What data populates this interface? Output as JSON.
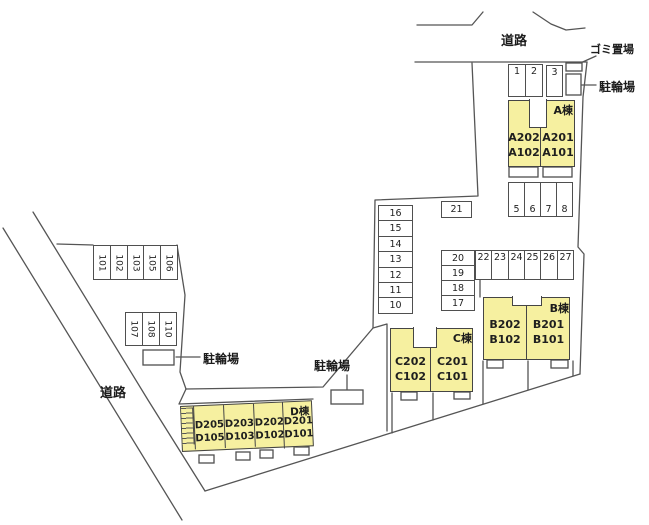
{
  "plan": {
    "roads": {
      "top": "道路",
      "left": "道路"
    },
    "facilities": {
      "garbage": "ゴミ置場",
      "bike_top": "駐輪場",
      "bike_left": "駐輪場",
      "bike_mid": "駐輪場"
    },
    "buildings": {
      "a": {
        "name": "A棟",
        "units": [
          {
            "top": "A202",
            "bottom": "A102"
          },
          {
            "top": "A201",
            "bottom": "A101"
          }
        ]
      },
      "b": {
        "name": "B棟",
        "units": [
          {
            "top": "B202",
            "bottom": "B102"
          },
          {
            "top": "B201",
            "bottom": "B101"
          }
        ]
      },
      "c": {
        "name": "C棟",
        "units": [
          {
            "top": "C202",
            "bottom": "C102"
          },
          {
            "top": "C201",
            "bottom": "C101"
          }
        ]
      },
      "d": {
        "name": "D棟",
        "units": [
          {
            "top": "D205",
            "bottom": "D105"
          },
          {
            "top": "D203",
            "bottom": "D103"
          },
          {
            "top": "D202",
            "bottom": "D102"
          },
          {
            "top": "D201",
            "bottom": "D101"
          }
        ]
      }
    },
    "parking": {
      "row_1_2": [
        "1",
        "2"
      ],
      "stall_3": "3",
      "row_5_8": [
        "5",
        "6",
        "7",
        "8"
      ],
      "stall_21": "21",
      "col_16_10": [
        "16",
        "15",
        "14",
        "13",
        "12",
        "11",
        "10"
      ],
      "col_20_17": [
        "20",
        "19",
        "18",
        "17"
      ],
      "row_22_27": [
        "22",
        "23",
        "24",
        "25",
        "26",
        "27"
      ],
      "row_101_106": [
        "101",
        "102",
        "103",
        "105",
        "106"
      ],
      "row_107_110": [
        "107",
        "108",
        "110"
      ]
    },
    "colors": {
      "building_fill": "#f6f0a0",
      "line": "#555555"
    }
  }
}
